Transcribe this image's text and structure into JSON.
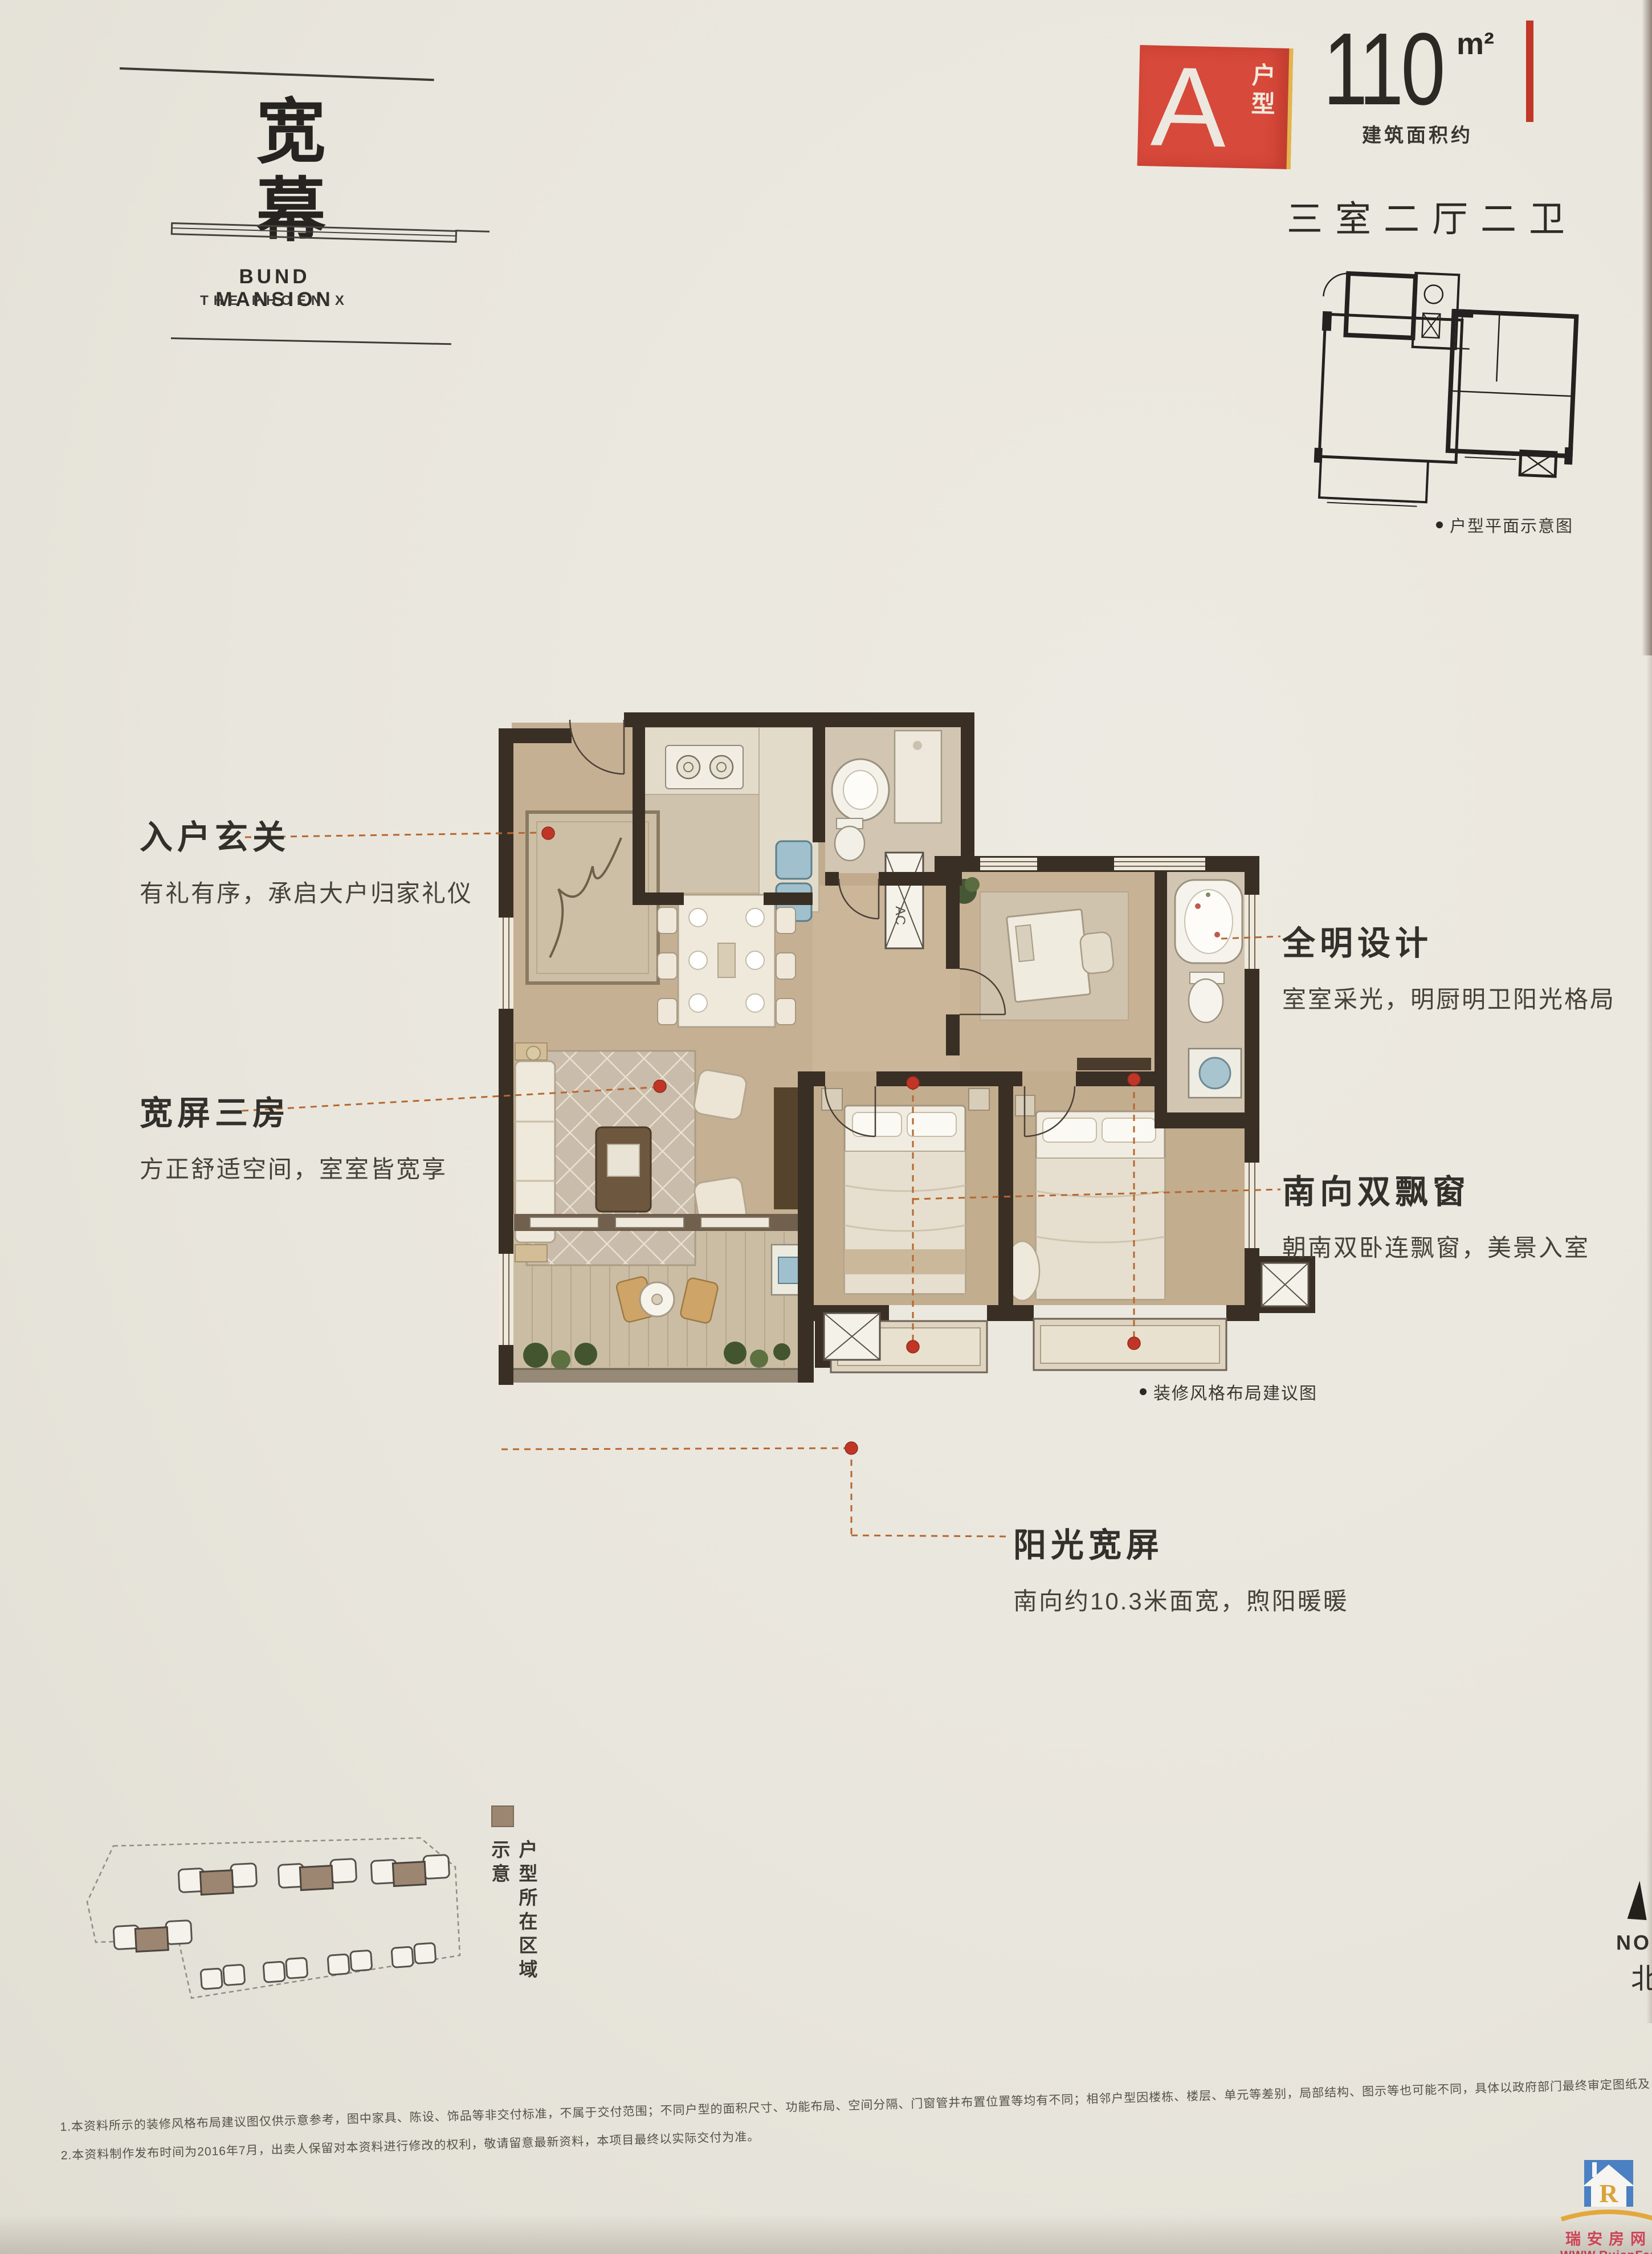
{
  "brand": {
    "vertical_title": "宽幕",
    "name_en": "BUND MANSION",
    "tagline_en": "THE PHOENIX"
  },
  "badge": {
    "letter": "A",
    "type_label": "户型",
    "area_value": "110",
    "area_unit": "m²",
    "area_note": "建筑面积约",
    "layout_summary": "三室二厅二卫",
    "schematic_caption": "户型平面示意图"
  },
  "callouts": [
    {
      "title": "入户玄关",
      "desc": "有礼有序，承启大户归家礼仪",
      "side": "left"
    },
    {
      "title": "宽屏三房",
      "desc": "方正舒适空间，室室皆宽享",
      "side": "left"
    },
    {
      "title": "全明设计",
      "desc": "室室采光，明厨明卫阳光格局",
      "side": "right"
    },
    {
      "title": "南向双飘窗",
      "desc": "朝南双卧连飘窗，美景入室",
      "side": "right"
    },
    {
      "title": "阳光宽屏",
      "desc": "南向约10.3米面宽，煦阳暖暖",
      "side": "bottom"
    }
  ],
  "floorplan_caption": "装修风格布局建议图",
  "ac_label": "AC",
  "siteplan_caption": "户型所在区域示意",
  "north": {
    "label_en": "NORTH",
    "label_cn": "北"
  },
  "disclaimers": [
    "1.本资料所示的装修风格布局建议图仅供示意参考，图中家具、陈设、饰品等非交付标准，不属于交付范围；不同户型的面积尺寸、功能布局、空间分隔、门窗管井布置位置等均有不同；相邻户型因楼栋、楼层、单元等差别，局部结构、图示等也可能不同，具体以政府部门最终审定图纸及《商品房买卖合同》约定为准。",
    "2.本资料制作发布时间为2016年7月，出卖人保留对本资料进行修改的权利，敬请留意最新资料，本项目最终以实际交付为准。"
  ],
  "watermark": {
    "line1": "瑞安房网",
    "line2": "WWW.RuianFang.Com",
    "line3": "瑞安房地产门户网站",
    "logo_letter": "R"
  },
  "colors": {
    "paper": "#e9e6dd",
    "accent_red": "#d7493a",
    "bar_red": "#c23727",
    "dot_red": "#c13527",
    "dash_orange": "#b5672f",
    "wall_brown": "#392f25",
    "floor_wood": "#c4ae91",
    "highlight_tan": "#9c8672",
    "watermark_blue": "#4b80c2",
    "watermark_gold": "#e2a83e",
    "watermark_red": "#cf4356"
  }
}
